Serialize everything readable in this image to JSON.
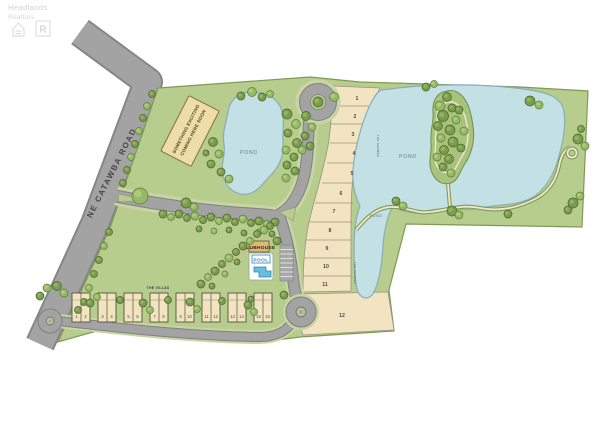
{
  "watermark": {
    "line1": "Headlands",
    "line2": "Realtors",
    "icons": [
      "equal-housing-icon",
      "realtor-icon"
    ]
  },
  "road": {
    "label": "NE CATAWBA ROAD"
  },
  "sign": {
    "line1": "SOMETHING EXCITING",
    "line2": "COMING HERE SOON"
  },
  "ponds": {
    "left": "POND",
    "main": "POND",
    "finger": "POND"
  },
  "labels": {
    "shores_upper": "THE SHORES",
    "shores_lower": "THE SHORES",
    "villas_section": "THE VILLAS",
    "clubhouse": "CLUBHOUSE",
    "pool": "POOL"
  },
  "lots": {
    "numbers": [
      "1",
      "2",
      "3",
      "4",
      "5",
      "6",
      "7",
      "8",
      "9",
      "10",
      "11",
      "12"
    ]
  },
  "villas": {
    "buildings": [
      [
        "1",
        "2"
      ],
      [
        "3",
        "4"
      ],
      [
        "5",
        "6"
      ],
      [
        "7",
        "8"
      ],
      [
        "9",
        "10"
      ],
      [
        "11",
        "12"
      ],
      [
        "13",
        "14"
      ],
      [
        "15",
        "16"
      ]
    ]
  },
  "colors": {
    "site_green": "#b6cd8d",
    "pond_blue": "#c3e0e5",
    "road_gray": "#a3a3a3",
    "lot_tan": "#f2e4c0",
    "tree_green": "#7a9c4e",
    "pool_blue": "#66bede"
  }
}
